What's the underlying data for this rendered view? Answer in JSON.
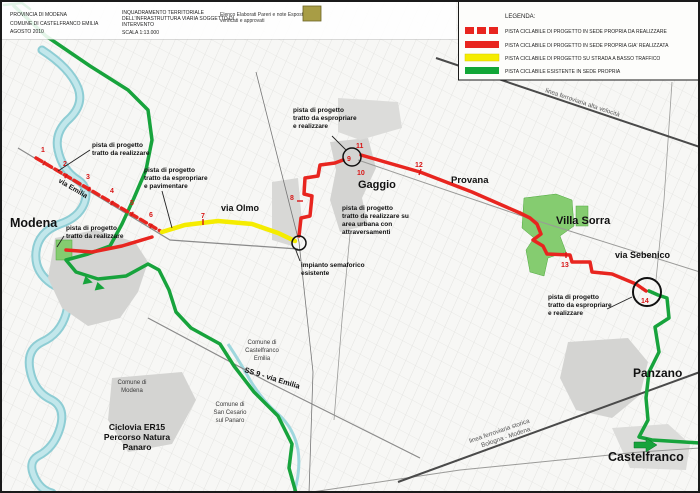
{
  "title_block": {
    "left": [
      "PROVINCIA DI MODENA",
      "COMUNE DI CASTELFRANCO EMILIA",
      "AGOSTO 2010"
    ],
    "center": [
      "INQUADRAMENTO TERRITORIALE",
      "DELL'INFRASTRUTTURA VIARIA SOGGETTO DI",
      "INTERVENTO",
      "SCALA 1:13.000"
    ],
    "right": [
      "Elenco Elaborati Pareri e note Esposte",
      "verificati e approvati"
    ]
  },
  "legend": {
    "title": "LEGENDA:",
    "items": [
      {
        "style": "red-dashed",
        "label": "PISTA CICLABILE DI PROGETTO IN SEDE PROPRIA DA REALIZZARE"
      },
      {
        "style": "red-solid",
        "label": "PISTA CICLABILE DI PROGETTO IN SEDE PROPRIA GIA' REALIZZATA"
      },
      {
        "style": "yellow-solid",
        "label": "PISTA CICLABILE DI PROGETTO SU STRADA A BASSO TRAFFICO"
      },
      {
        "style": "green-solid",
        "label": "PISTA CICLABILE ESISTENTE IN SEDE PROPRIA"
      }
    ]
  },
  "colors": {
    "project_red": "#e8251f",
    "low_traffic_yellow": "#f5ec00",
    "existing_green": "#17a33c",
    "river_blue": "#9ed7dd",
    "urban_gray": "#d4d4d2",
    "green_area": "#85cc70"
  },
  "places": {
    "modena": "Modena",
    "gaggio": "Gaggio",
    "provana": "Provana",
    "villa_sorra": "Villa Sorra",
    "panzano": "Panzano",
    "castelfranco": "Castelfranco"
  },
  "roads": {
    "via_olmo": "via Olmo",
    "via_sebenico": "via Sebenico",
    "ss9": "SS 9 - via Emilia",
    "via_emilia_route": "via Emilia"
  },
  "railways": {
    "alta_velocita": "linea ferroviaria alta velocità",
    "storica": [
      "linea ferroviaria storica",
      "Bologna - Modena"
    ]
  },
  "municipalities": {
    "modena": [
      "Comune di",
      "Modena"
    ],
    "castelfranco": [
      "Comune di",
      "Castelfranco",
      "Emilia"
    ],
    "san_cesario": [
      "Comune di",
      "San Cesario",
      "sul Panaro"
    ]
  },
  "ciclovia": [
    "Ciclovia ER15",
    "Percorso Natura",
    "Panaro"
  ],
  "annotations": {
    "realizzare_nw": [
      "pista di progetto",
      "tratto da realizzare"
    ],
    "espropriare_pavimentare": [
      "pista di progetto",
      "tratto da espropriare",
      "e pavimentare"
    ],
    "realizzare_modena": [
      "pista di progetto",
      "tratto da realizzare"
    ],
    "espropriare_gaggio": [
      "pista di progetto",
      "tratto da espropriare",
      "e realizzare"
    ],
    "area_urbana": [
      "pista di progetto",
      "tratto da realizzare su",
      "area urbana con",
      "attraversamenti"
    ],
    "semaforo": [
      "impianto semaforico",
      "esistente"
    ],
    "espropriare_panzano": [
      "pista di progetto",
      "tratto da espropriare",
      "e realizzare"
    ]
  },
  "segment_numbers": [
    "1",
    "2",
    "3",
    "4",
    "5",
    "6",
    "7",
    "8",
    "9",
    "10",
    "11",
    "12",
    "13",
    "14"
  ]
}
